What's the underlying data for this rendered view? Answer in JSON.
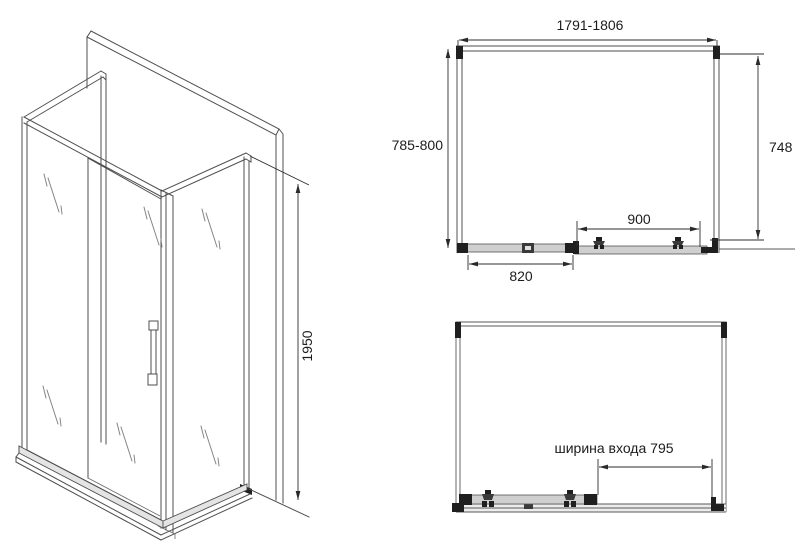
{
  "drawing": {
    "type": "shower-enclosure-technical-drawing",
    "iso_view": {
      "height_dim": "1950"
    },
    "plan_view": {
      "width_dim": "1791-1806",
      "left_depth_dim": "785-800",
      "right_depth_dim": "748",
      "door_width_dim": "900",
      "fixed_panel_dim": "820"
    },
    "front_view": {
      "entrance_dim": "ширина входа 795"
    },
    "colors": {
      "background": "#ffffff",
      "line": "#4f4f4f",
      "dimension": "#2e2e2e",
      "glass_line": "#9a9a9a",
      "dark_profile": "#1f1f1f",
      "base_fill": "#e4e4e4"
    }
  }
}
